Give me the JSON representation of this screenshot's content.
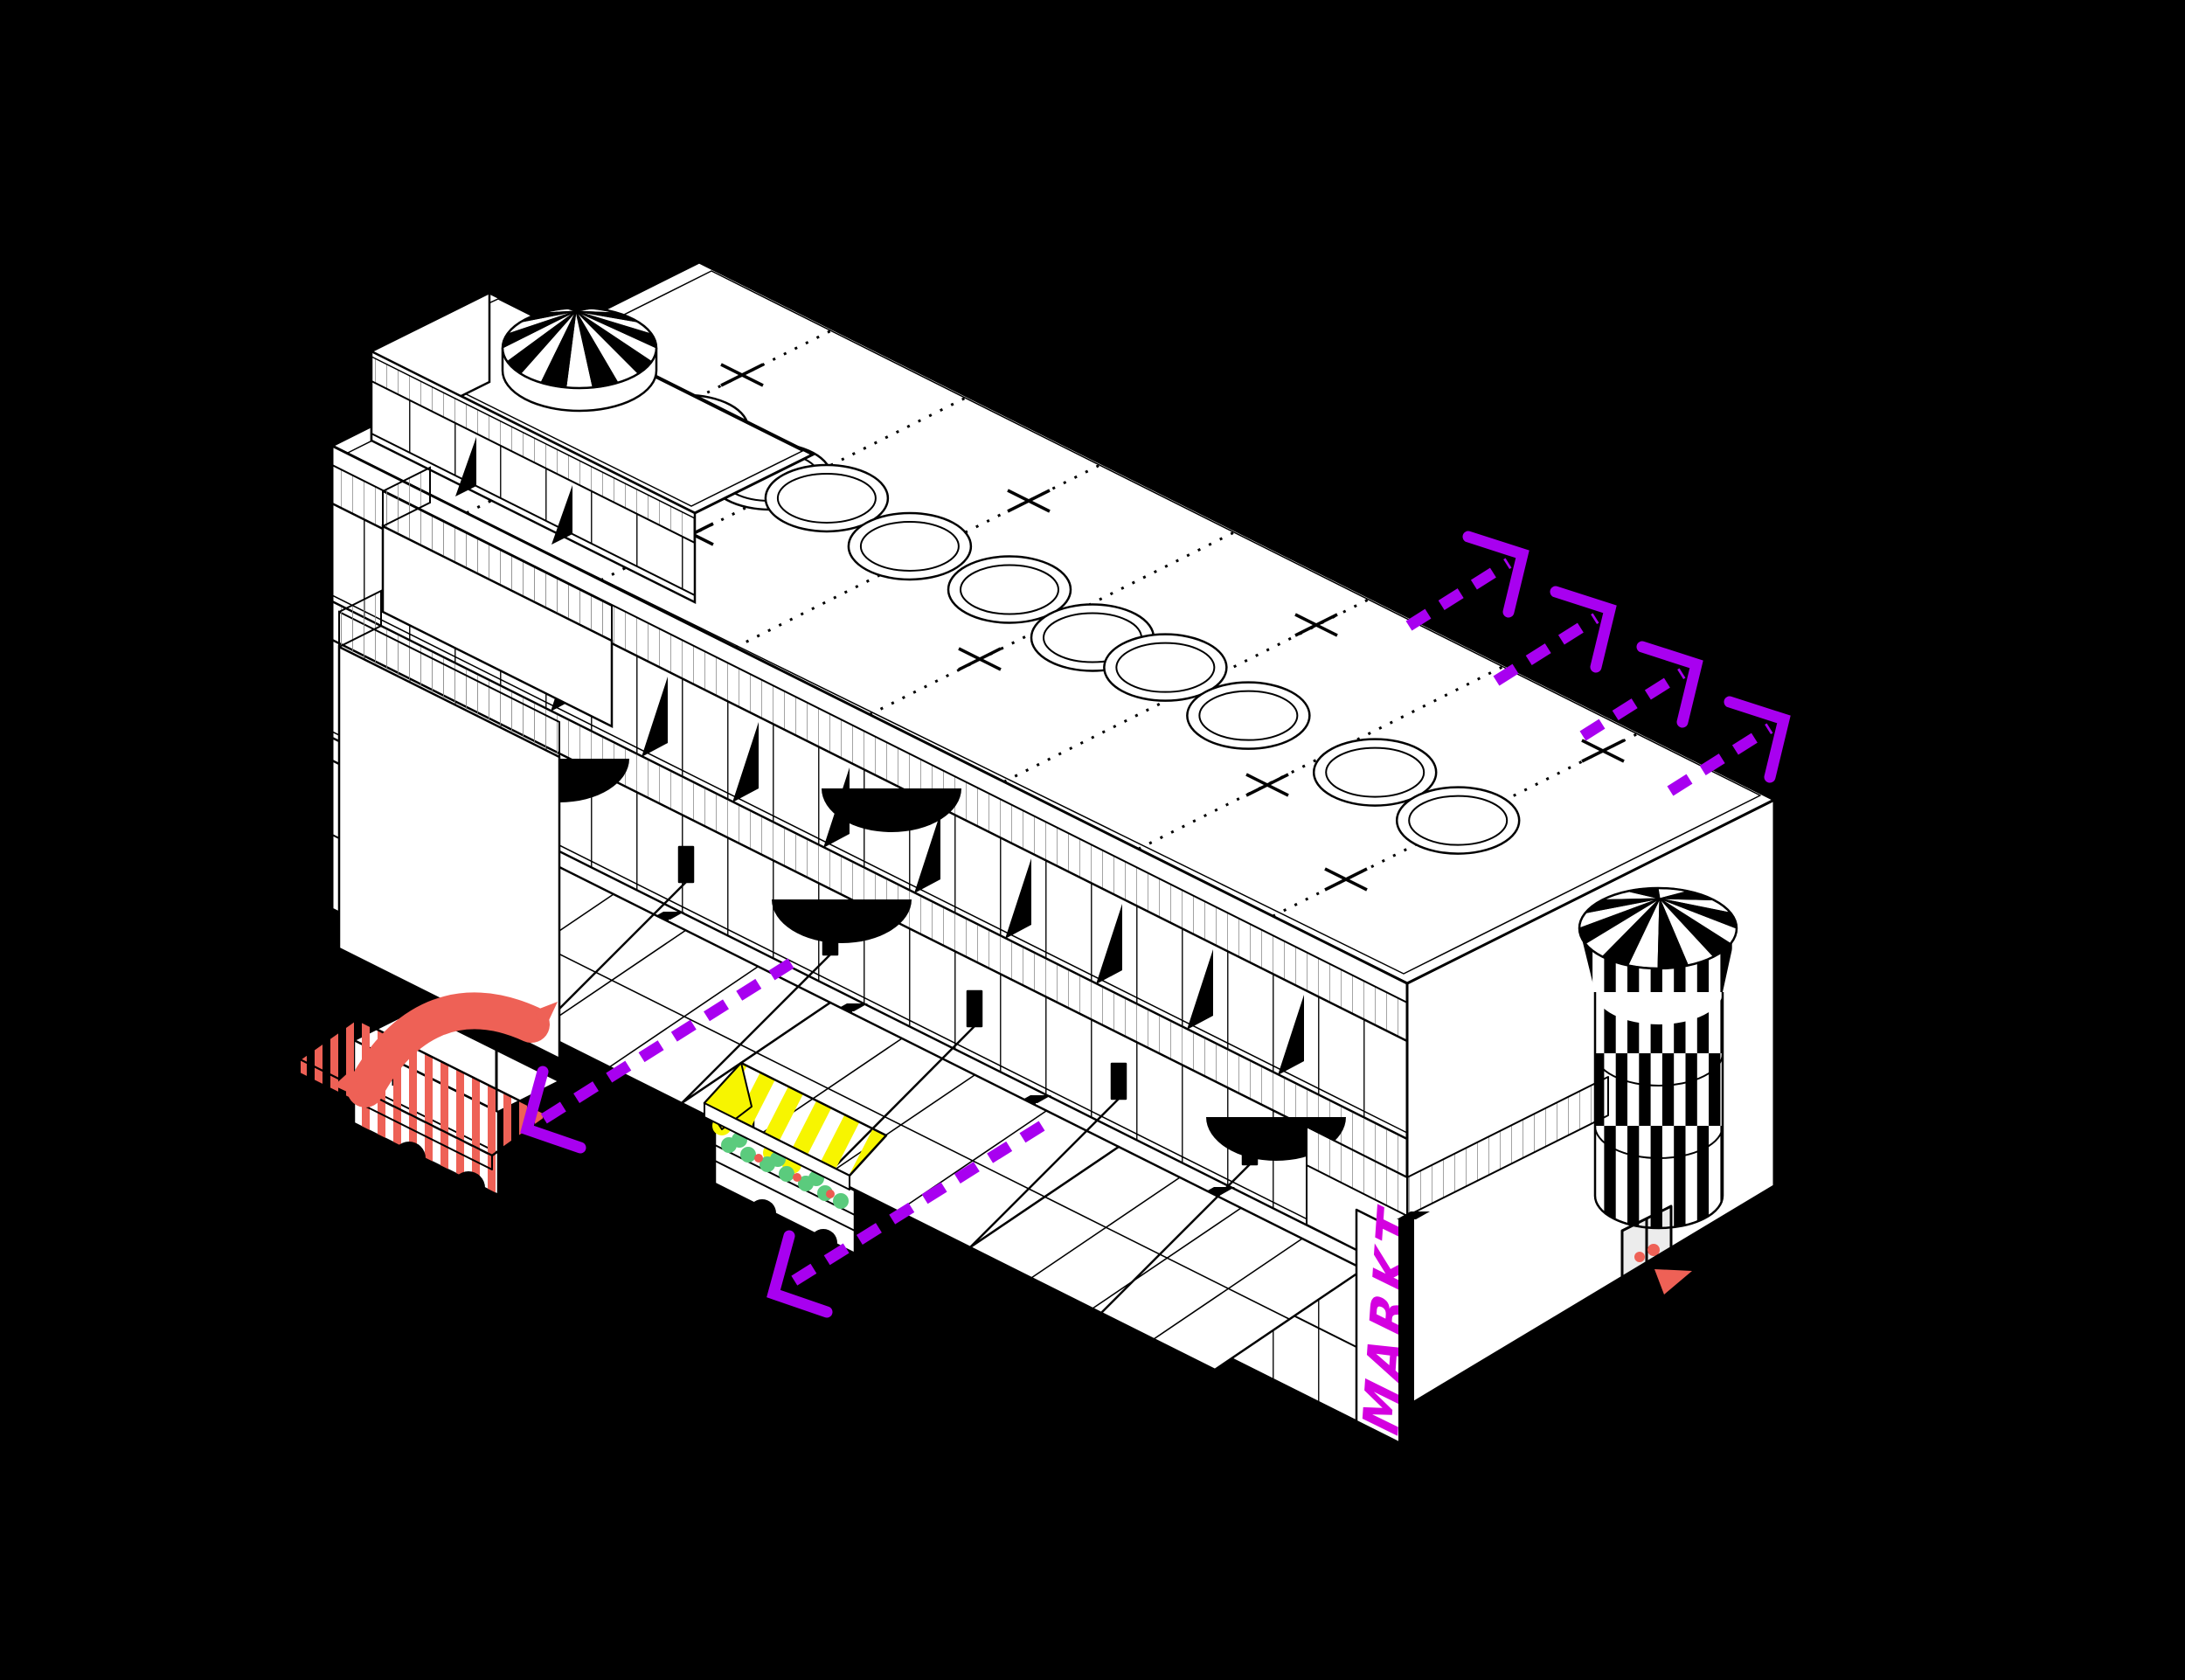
{
  "scene": {
    "description": "Isometric architectural diagram of a market hall building on a black background",
    "background_color": "#000000",
    "ink_color": "#000000",
    "paper_color": "#ffffff"
  },
  "signage": {
    "markt_label": "MARKT",
    "markt_color": "#d400e0"
  },
  "flow_arrows": {
    "color": "#a800f0",
    "up_right_count": 4,
    "down_left_count": 2,
    "style": "dashed with solid chevron head"
  },
  "roof": {
    "bay_lines": 7,
    "skylight_pairs": 5,
    "cross_marks": 8,
    "skylight_shape": "circular ring"
  },
  "facade": {
    "window_shadow_triangles": 9,
    "awning_semicircles": 4,
    "canopy_segments": 3,
    "storefront_pillars": 6,
    "cable_plates": 6
  },
  "circus_tents": {
    "left_tent_stripes": 18,
    "right_tower_stripes": 16,
    "right_tower_bands": 3,
    "stripe_black": "#000000",
    "stripe_white": "#ffffff"
  },
  "entrance": {
    "door_color": "#ececec",
    "handle_color": "#ee6156",
    "handle_count": 2,
    "marker_color": "#ee6156"
  },
  "hot_dog_cart": {
    "sausage_color": "#ee6156",
    "stripe_color": "#ee6156",
    "body_color": "#ffffff"
  },
  "produce_van": {
    "awning_yellow": "#f7f500",
    "produce_green": "#5bcb7d",
    "accent_red": "#ee5b50",
    "body_color": "#ffffff"
  }
}
